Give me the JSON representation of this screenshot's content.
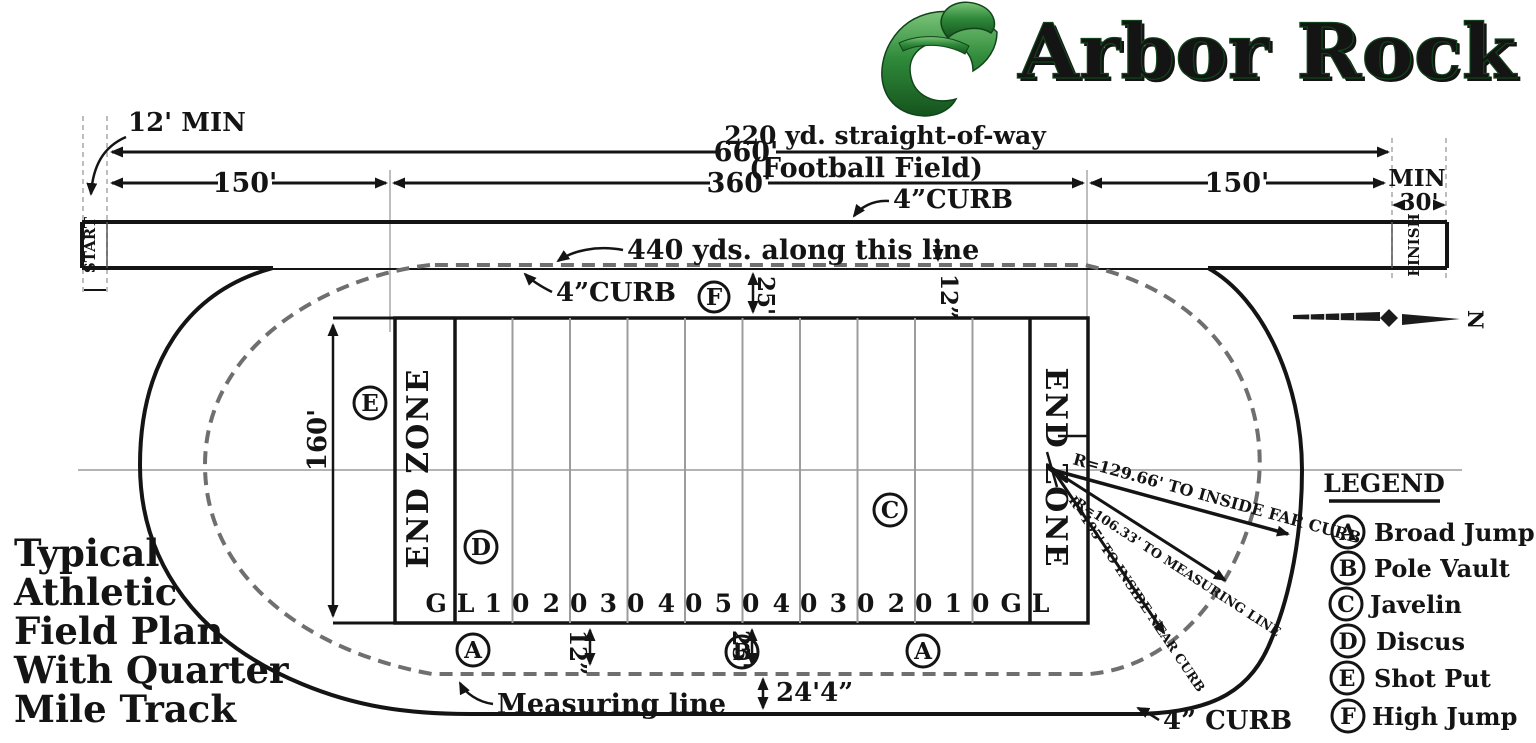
{
  "logo": {
    "text": "Arbor Rock"
  },
  "plan_title": {
    "lines": [
      "Typical",
      "Athletic",
      "Field Plan",
      "With Quarter",
      "Mile Track"
    ]
  },
  "dims": {
    "min12": "12' MIN",
    "d660": "660'",
    "straightofway": "220 yd. straight-of-way",
    "football_field": "(Football Field)",
    "d360": "360'",
    "d150_left": "150'",
    "d150_right": "150'",
    "min_label": "MIN",
    "d30": "30'",
    "curb_top": "4”CURB",
    "curb_infield": "4”CURB",
    "curb_bottom": "4” CURB",
    "yds440": "440 yds. along this line",
    "d25_top": "25'",
    "d12_top": "12”",
    "d160": "160'",
    "d12_bottom": "12”",
    "d25_bottom": "25'",
    "d24_4": "24'4”",
    "measuring_line": "Measuring line",
    "r_far_curb": "R=129.66' TO INSIDE FAR CURB",
    "r_measuring": "R=106.33' TO MEASURING LINE",
    "r_near_curb": "R=105' TO INSIDE NEAR CURB"
  },
  "track": {
    "start": "START",
    "finish": "FINISH",
    "end_zone_left": "END ZONE",
    "end_zone_right": "END ZONE",
    "yard_labels": [
      "GL",
      "10",
      "20",
      "30",
      "40",
      "50",
      "40",
      "30",
      "20",
      "10",
      "GL"
    ],
    "north": "N"
  },
  "markers": {
    "a": "A",
    "b": "B",
    "c": "C",
    "d": "D",
    "e": "E",
    "f": "F"
  },
  "legend": {
    "title": "LEGEND",
    "items": [
      {
        "key": "A",
        "label": "Broad Jump"
      },
      {
        "key": "B",
        "label": "Pole Vault"
      },
      {
        "key": "C",
        "label": "Javelin"
      },
      {
        "key": "D",
        "label": "Discus"
      },
      {
        "key": "E",
        "label": "Shot Put"
      },
      {
        "key": "F",
        "label": "High Jump"
      }
    ]
  },
  "colors": {
    "ink": "#141414",
    "gray_line": "#a8a8a8",
    "measure_dash": "#6f6f6f",
    "logo_green": "#2f8a3a",
    "logo_dark": "#15531d"
  }
}
